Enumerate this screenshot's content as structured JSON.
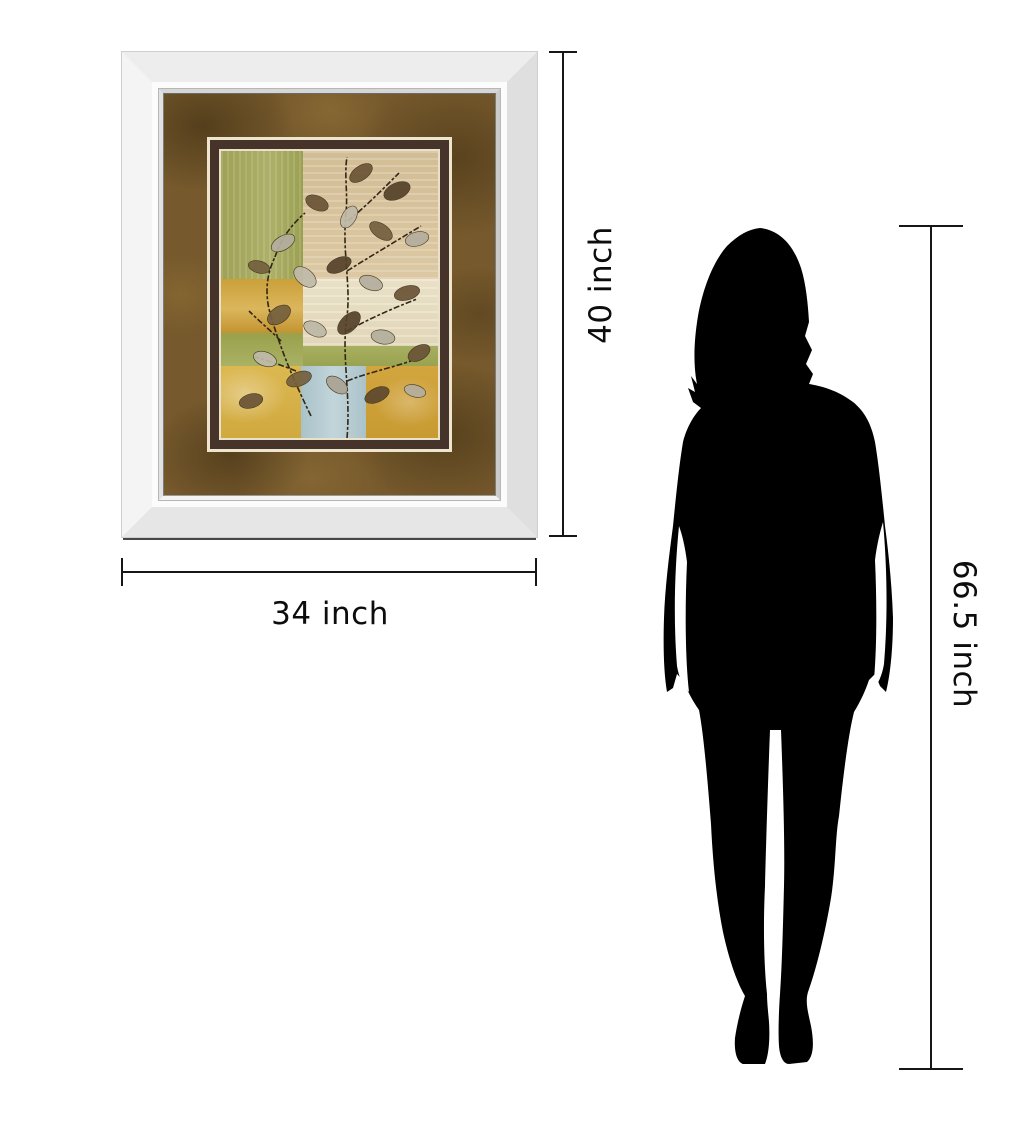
{
  "page": {
    "background": "#ffffff"
  },
  "product": {
    "name": "mirror-framed-wall-art",
    "frame": {
      "style": "beveled-mirror-frame",
      "frame_color": "#ededed",
      "mat_color": "#76592c",
      "inner_border_color": "#46342a",
      "liner_color": "#ede5cd"
    },
    "artwork": {
      "description": "abstract-leaf-branch-collage-on-color-blocks",
      "colors": {
        "green": "#a5a75c",
        "beige": "#d8c49e",
        "cream": "#e7ddc3",
        "gold_band": "#caa03a",
        "yellow": "#d9b44e",
        "blue": "#b4c9cf",
        "gold_bottom": "#c89a32",
        "leaf_brown": "#6a5436",
        "leaf_silver": "#b4ae9e",
        "branch": "#322615"
      }
    }
  },
  "dimensions": {
    "width_label": "34 inch",
    "height_label": "40 inch",
    "person_height_label": "66.5 inch",
    "line_color": "#161616"
  },
  "silhouette": {
    "name": "woman-silhouette",
    "color": "#000000"
  }
}
